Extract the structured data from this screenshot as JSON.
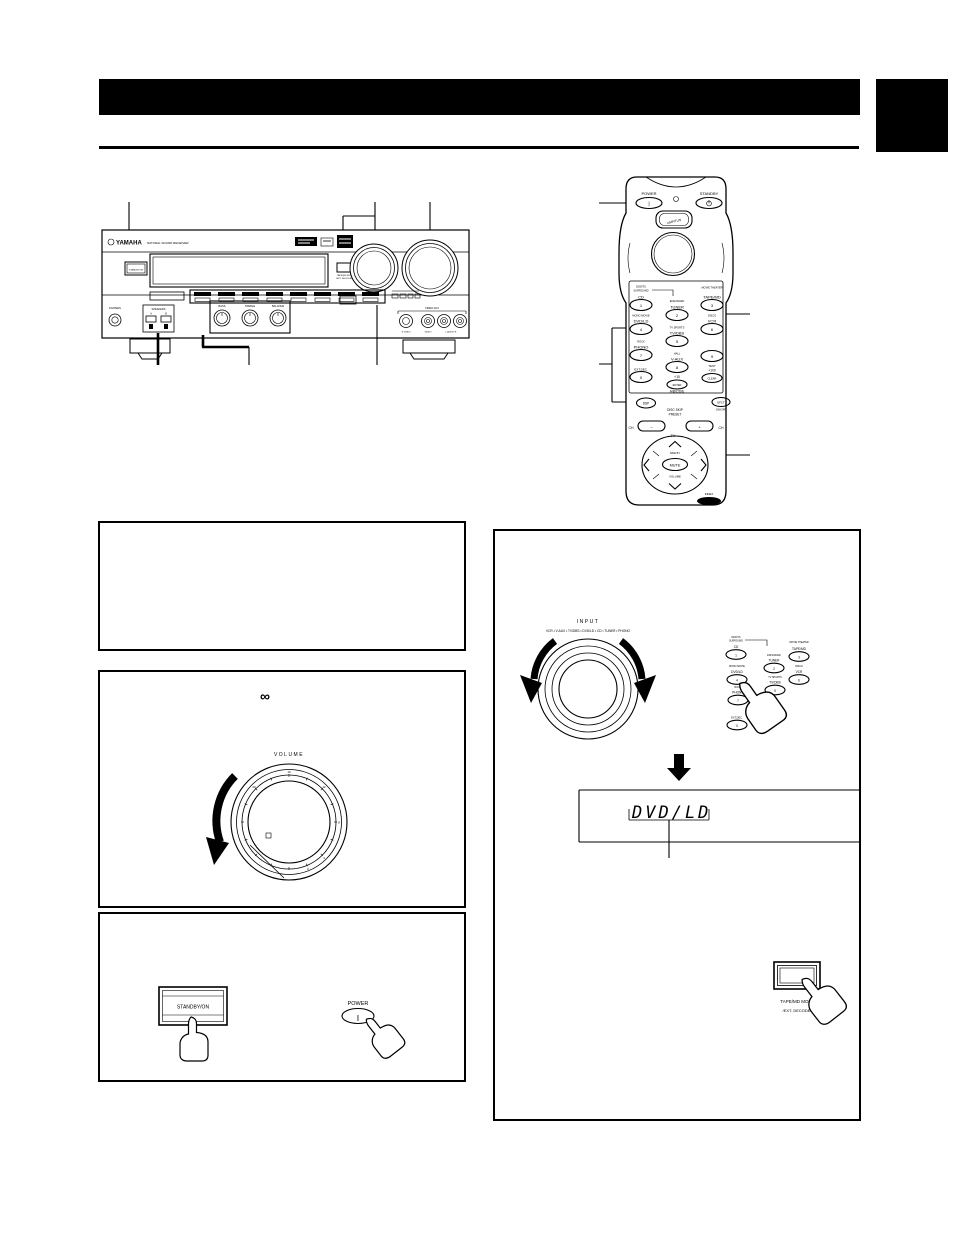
{
  "receiver": {
    "brand": "YAMAHA",
    "brand_tagline": "NATURAL SOUND RECEIVER",
    "standby_on_label": "STANDBY/ON",
    "input_label": "INPUT",
    "volume_label": "VOLUME",
    "phones_label": "PHONES",
    "speakers_label": "SPEAKERS",
    "speakers_a": "A",
    "speakers_b": "B",
    "bass_label": "BASS",
    "treble_label": "TREBLE",
    "balance_label": "BALANCE",
    "tape_mon_line1": "TAPE/MD MON",
    "tape_mon_line2": "/EXT. DECODER",
    "video_aux_label": "VIDEO AUX",
    "s_video_label": "S VIDEO",
    "video_label": "VIDEO",
    "audio_lr_label": "L  AUDIO  R"
  },
  "remote": {
    "power_label": "POWER",
    "power_symbol": "|",
    "standby_label": "STANDBY",
    "amp_tun_label": "AMP/TUN",
    "keys": [
      {
        "sub1": "DD/DTS",
        "sub2": "SURROUND",
        "label": "CD",
        "num": "1"
      },
      {
        "sub1": "ENHANCED",
        "label": "TUNER",
        "num": "2"
      },
      {
        "sub1": "MOVIE THEATER",
        "label": "TAPE/MD",
        "num": "3"
      },
      {
        "sub1": "MONO MOVIE",
        "label": "DVD/LD",
        "num": "4"
      },
      {
        "sub1": "TV SPORTS",
        "label": "TV/DBS",
        "num": "5"
      },
      {
        "sub1": "DISCO",
        "label": "VCR",
        "num": "6"
      },
      {
        "sub1": "ROCK",
        "label": "PHONO",
        "num": "7"
      },
      {
        "sub1": "HALL",
        "label": "V-AUX",
        "num": "8"
      },
      {
        "num": "9"
      },
      {
        "label": "EXT.DEC.",
        "num": "0"
      }
    ],
    "test_label": "TEST",
    "plus100_label": "+100",
    "clear_label": "CLEAR",
    "plus10_label": "+10",
    "enter_label": "ENTER",
    "abcde_label": "A/B/C/D/E",
    "dsp_label": "DSP",
    "efct_label": "EFCT",
    "onoff_label": "ON/OFF",
    "disc_skip_label": "DISC SKIP",
    "preset_label": "PRESET",
    "ch_label": "CH",
    "minus_label": "−",
    "plus_label": "+",
    "tv_label": "TV",
    "side_by_label": "SIDE BY",
    "mute_label": "MUTE",
    "volume_label": "VOLUME",
    "index_label": "INDEX"
  },
  "boxes": {
    "volume": {
      "infinity": "∞",
      "volume_label": "VOLUME",
      "ticks": [
        "16",
        "12",
        "8",
        "4",
        "0",
        "20"
      ]
    },
    "power": {
      "standby_on": "STANDBY/ON",
      "power": "POWER",
      "power_symbol": "|"
    },
    "input": {
      "input_label": "INPUT",
      "sources": "VCR • V-AUX • TV/DBS • DVD/LD • CD • TUNER • PHONO",
      "display_text": "DVD/LD",
      "tape_line1": "TAPE/MD MON",
      "tape_line2": "/EXT. DECODER"
    }
  }
}
